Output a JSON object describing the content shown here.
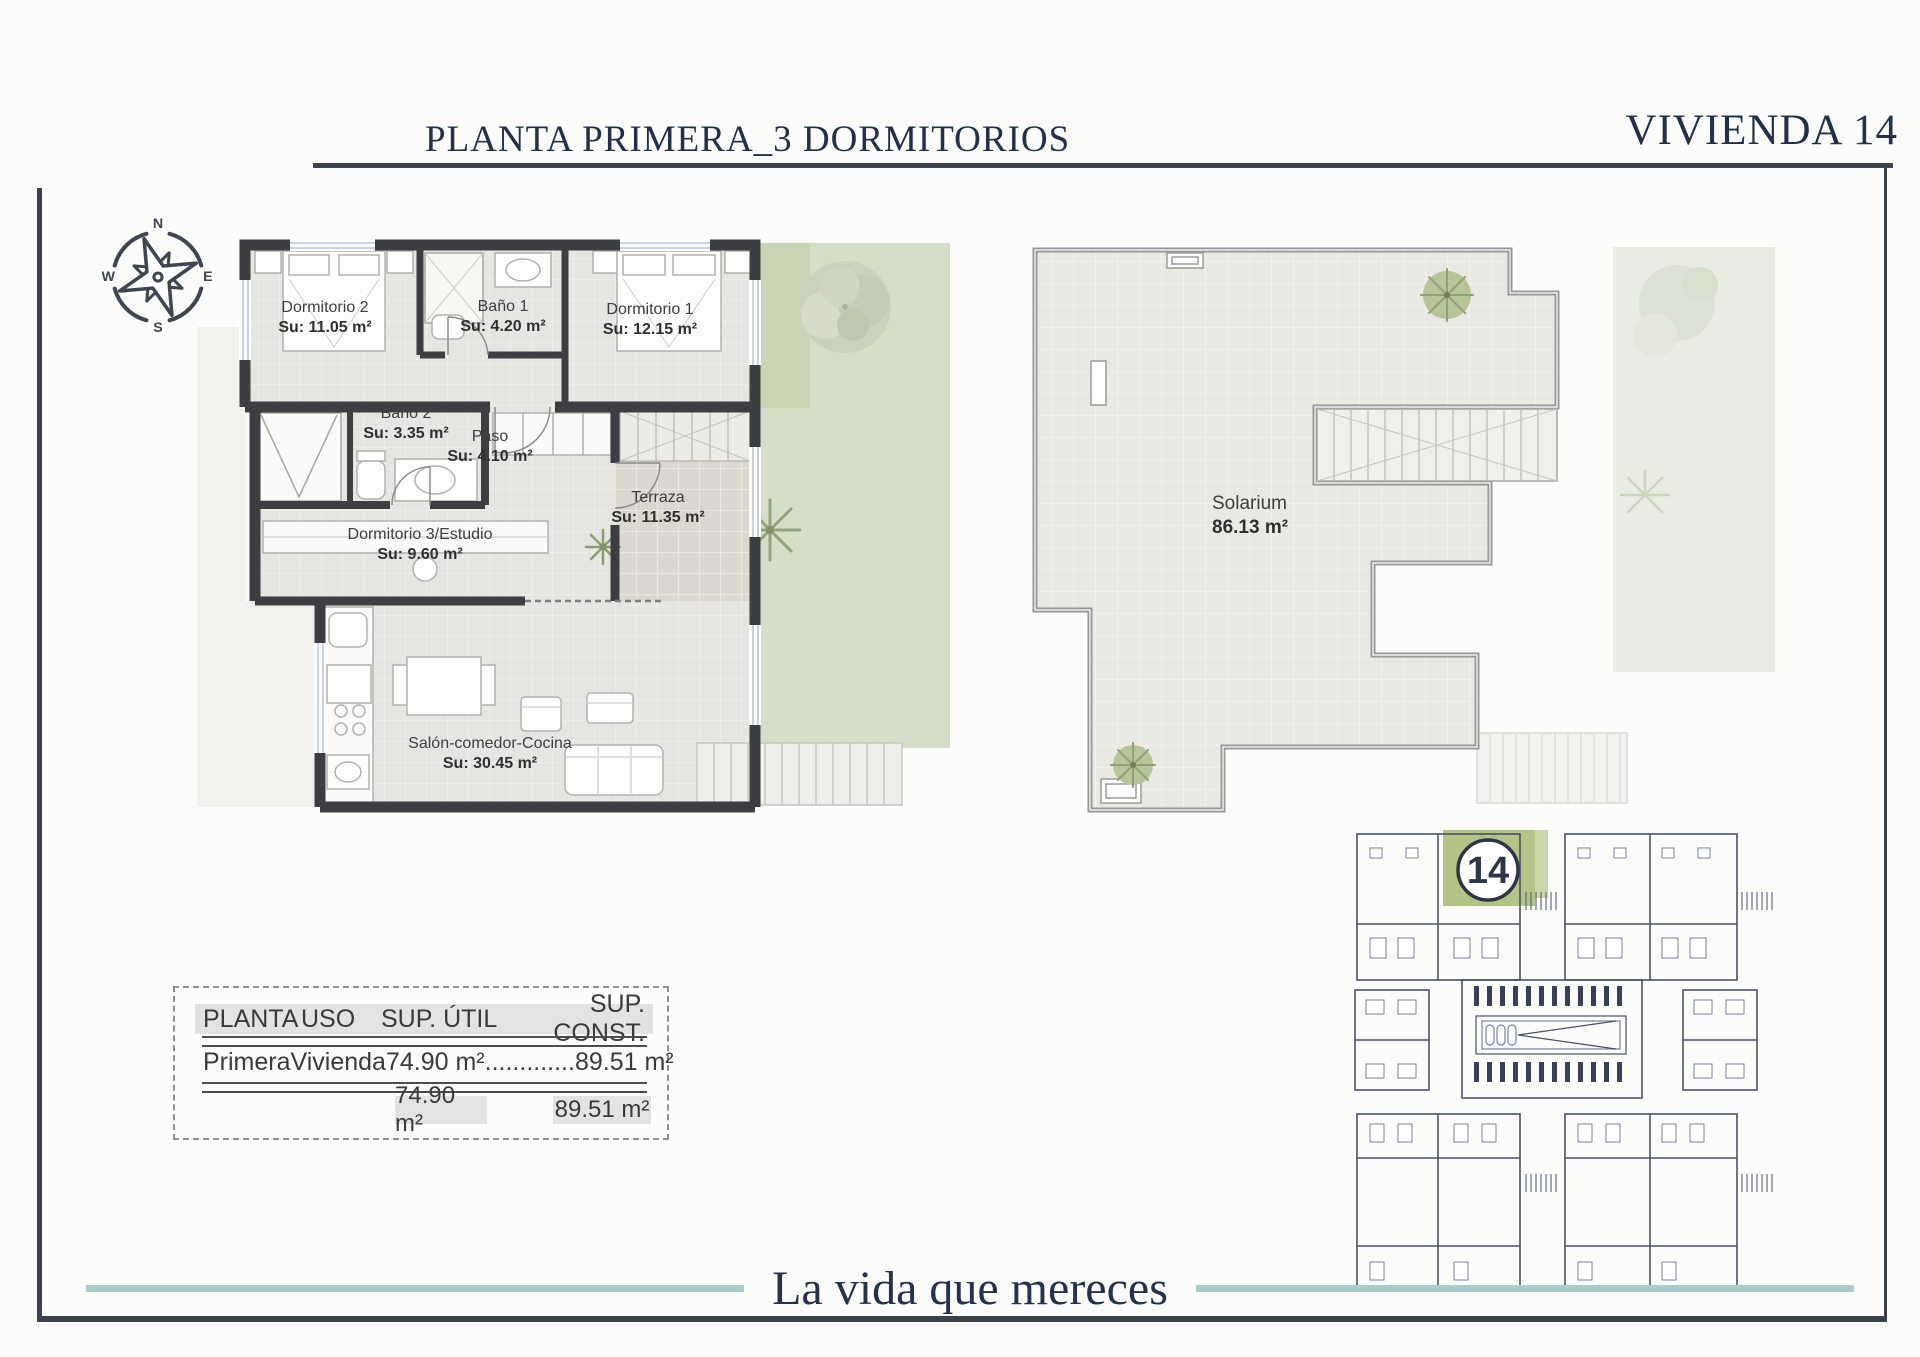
{
  "header": {
    "title": "PLANTA PRIMERA_3 DORMITORIOS",
    "unit": "VIVIENDA 14"
  },
  "compass": {
    "n": "N",
    "e": "E",
    "s": "S",
    "w": "W"
  },
  "floor_plan": {
    "rooms": [
      {
        "id": "dormitorio2",
        "name": "Dormitorio 2",
        "area": "Su: 11.05 m²"
      },
      {
        "id": "bano1",
        "name": "Baño 1",
        "area": "Su: 4.20 m²"
      },
      {
        "id": "dormitorio1",
        "name": "Dormitorio 1",
        "area": "Su: 12.15 m²"
      },
      {
        "id": "bano2",
        "name": "Baño 2",
        "area": "Su: 3.35 m²"
      },
      {
        "id": "paso",
        "name": "Paso",
        "area": "Su: 4.10 m²"
      },
      {
        "id": "dormitorio3",
        "name": "Dormitorio 3/Estudio",
        "area": "Su: 9.60 m²"
      },
      {
        "id": "terraza",
        "name": "Terraza",
        "area": "Su: 11.35 m²"
      },
      {
        "id": "salon",
        "name": "Salón-comedor-Cocina",
        "area": "Su: 30.45 m²"
      }
    ]
  },
  "solarium_plan": {
    "name": "Solarium",
    "area": "86.13 m²"
  },
  "site_plan": {
    "unit_number": "14"
  },
  "areas_table": {
    "headers": [
      "PLANTA",
      "USO",
      "SUP. ÚTIL",
      "SUP. CONST."
    ],
    "row": {
      "planta": "Primera",
      "uso": "Vivienda",
      "sup_util": "74.90 m²",
      "dots": ".............",
      "sup_const": "89.51 m²"
    },
    "totals": {
      "sup_util": "74.90 m²",
      "sup_const": "89.51 m²"
    }
  },
  "footer": {
    "tagline": "La vida que mereces"
  },
  "colors": {
    "accent_navy": "#22304a",
    "frame_dark": "#3c424d",
    "teal_accent": "#a9cec9",
    "highlight_green": "#b2c586",
    "garden_green": "#d5dfc7"
  }
}
